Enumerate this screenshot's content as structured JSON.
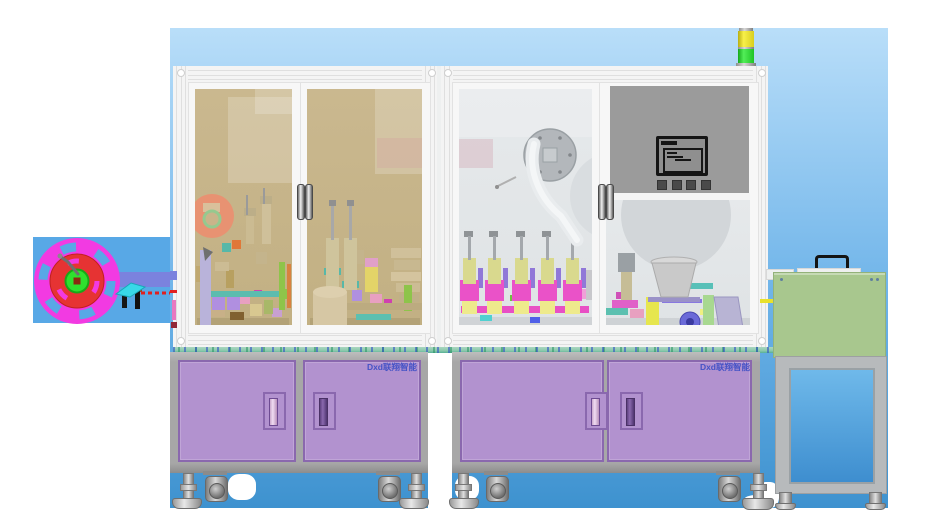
{
  "branding": {
    "label": "Dxd联翔智能",
    "label_color": "#4553c6"
  },
  "palette": {
    "sky-top": "#b9def9",
    "sky-mid": "#6fb4e9",
    "sky-bottom": "#3e92cf",
    "reel-backdrop": "#58a8e6",
    "frame": "#f2f2f2",
    "frame-line": "#dfdfdf",
    "glass-tan": "#c6b389",
    "glass-gray": "#e3e6e8",
    "panel-gray": "#9b9b9b",
    "cabinet-gray": "#a7a7a7",
    "door-purple": "#b292cf",
    "door-purple-dark": "#8a68ae",
    "label-blue": "#4553c6",
    "table-teal": "#8cc9ac",
    "table-teal-dark": "#57b096",
    "green-box": "#a8c78e",
    "unit-blue-top": "#6fb9ea",
    "unit-blue-bottom": "#3e8ecf",
    "stack-light-yellow": "#e8de25",
    "stack-light-green": "#35d53a",
    "reel-magenta": "#f23ae2",
    "reel-red": "#e63333",
    "hub-green": "#2ee12e"
  },
  "components": {
    "stack_light": "signal-tower-yellow-green",
    "film_reel": "magenta-unwind-reel",
    "hmi_monitor": "control-screen-4-buttons",
    "bowl_feeder": "vibratory-bowl-feeder",
    "rotary_disc": "gray-index-disc",
    "side_cart": "green-top-cart-blue-door"
  },
  "machinery": {
    "reel": [
      [
        95,
        272,
        75,
        15,
        "#7b82de"
      ],
      [
        122,
        290,
        5,
        18,
        "#161616"
      ],
      [
        135,
        288,
        5,
        21,
        "#111111"
      ],
      [
        133,
        285,
        9,
        7,
        "#a04818"
      ],
      [
        170,
        271,
        7,
        9,
        "#7b82de"
      ],
      [
        170,
        290,
        7,
        3,
        "#e02020"
      ],
      [
        172,
        300,
        4,
        20,
        "#e878c0"
      ],
      [
        171,
        322,
        6,
        6,
        "#902838"
      ]
    ],
    "window_l1": [
      [
        200,
        250,
        11,
        75,
        "#b9b3da"
      ],
      [
        246,
        195,
        2,
        20,
        "#9a9a9a"
      ],
      [
        263,
        188,
        2,
        16,
        "#9a9a9a"
      ],
      [
        244,
        208,
        12,
        8,
        "#bcae88"
      ],
      [
        246,
        216,
        8,
        28,
        "#cbbb92"
      ],
      [
        260,
        196,
        12,
        8,
        "#bcae88"
      ],
      [
        262,
        204,
        9,
        40,
        "#cfc09a"
      ],
      [
        279,
        262,
        6,
        48,
        "#8ec44a"
      ],
      [
        287,
        264,
        4,
        44,
        "#d8823f"
      ],
      [
        204,
        291,
        78,
        6,
        "#5cbcae"
      ],
      [
        268,
        291,
        14,
        6,
        "#e04838"
      ],
      [
        281,
        289,
        7,
        10,
        "#8ec44a"
      ],
      [
        212,
        294,
        13,
        16,
        "#b08fe0"
      ],
      [
        216,
        294,
        5,
        8,
        "#c2b083"
      ],
      [
        227,
        294,
        13,
        16,
        "#b08fe0"
      ],
      [
        231,
        294,
        5,
        8,
        "#c2b083"
      ],
      [
        196,
        266,
        10,
        16,
        "#c0a870"
      ],
      [
        215,
        262,
        14,
        9,
        "#ccbc94"
      ],
      [
        226,
        270,
        8,
        18,
        "#b8a060"
      ],
      [
        256,
        252,
        11,
        12,
        "#c4b48c"
      ],
      [
        240,
        297,
        10,
        7,
        "#e8a0c0"
      ],
      [
        254,
        290,
        8,
        6,
        "#d040b0"
      ],
      [
        250,
        304,
        12,
        12,
        "#d8c890"
      ],
      [
        230,
        312,
        14,
        8,
        "#806030"
      ],
      [
        205,
        308,
        20,
        9,
        "#c8b088"
      ],
      [
        264,
        300,
        9,
        14,
        "#a8b868"
      ],
      [
        272,
        308,
        10,
        9,
        "#c8a0d0"
      ],
      [
        197,
        318,
        92,
        8,
        "#b3a277"
      ],
      [
        222,
        243,
        9,
        9,
        "#57b8a8"
      ],
      [
        232,
        240,
        9,
        9,
        "#e07838"
      ]
    ],
    "window_l2": [
      [
        329,
        200,
        7,
        6,
        "#909090"
      ],
      [
        347,
        200,
        7,
        6,
        "#909090"
      ],
      [
        331,
        206,
        3,
        34,
        "#a8a8a8"
      ],
      [
        349,
        206,
        3,
        34,
        "#a8a8a8"
      ],
      [
        326,
        238,
        13,
        52,
        "#cfc49c"
      ],
      [
        344,
        238,
        13,
        52,
        "#cfc49c"
      ],
      [
        324,
        268,
        17,
        7,
        "#57b8a8"
      ],
      [
        342,
        281,
        17,
        7,
        "#57b8a8"
      ],
      [
        313,
        292,
        34,
        33,
        "#d6c7a4"
      ],
      [
        365,
        258,
        13,
        9,
        "#e0a0c8"
      ],
      [
        365,
        266,
        13,
        26,
        "#e3d468"
      ],
      [
        345,
        303,
        77,
        7,
        "#bcab80"
      ],
      [
        356,
        314,
        35,
        6,
        "#5cc0b0"
      ],
      [
        404,
        285,
        8,
        26,
        "#8ec44a"
      ],
      [
        391,
        248,
        30,
        10,
        "#d0c09a"
      ],
      [
        394,
        260,
        26,
        10,
        "#c8b890"
      ],
      [
        391,
        272,
        30,
        9,
        "#d4c49e"
      ],
      [
        396,
        283,
        24,
        9,
        "#ccbc94"
      ],
      [
        399,
        294,
        20,
        8,
        "#c0b088"
      ],
      [
        352,
        290,
        10,
        11,
        "#b090e0"
      ],
      [
        370,
        294,
        12,
        9,
        "#e8a0c0"
      ],
      [
        384,
        299,
        8,
        8,
        "#d040b0"
      ],
      [
        356,
        250,
        8,
        14,
        "#c4b48c"
      ],
      [
        310,
        318,
        110,
        7,
        "#b3a277"
      ]
    ],
    "window_r1": [
      [
        468,
        236,
        3,
        24,
        "#a4a8ac"
      ],
      [
        464,
        231,
        9,
        6,
        "#8f9396"
      ],
      [
        463,
        258,
        13,
        26,
        "#d9d98e"
      ],
      [
        460,
        280,
        19,
        21,
        "#ea52c8"
      ],
      [
        466,
        283,
        8,
        11,
        "#f6ddf0"
      ],
      [
        462,
        299,
        15,
        15,
        "#eeea8c"
      ],
      [
        478,
        268,
        5,
        20,
        "#9078d8"
      ],
      [
        493,
        236,
        3,
        24,
        "#a4a8ac"
      ],
      [
        489,
        231,
        9,
        6,
        "#8f9396"
      ],
      [
        488,
        258,
        13,
        26,
        "#d9d98e"
      ],
      [
        485,
        280,
        19,
        21,
        "#ea52c8"
      ],
      [
        491,
        283,
        8,
        11,
        "#f6ddf0"
      ],
      [
        487,
        299,
        15,
        15,
        "#eeea8c"
      ],
      [
        503,
        268,
        5,
        20,
        "#9078d8"
      ],
      [
        520,
        236,
        3,
        24,
        "#a4a8ac"
      ],
      [
        516,
        231,
        9,
        6,
        "#8f9396"
      ],
      [
        515,
        258,
        13,
        26,
        "#d9d98e"
      ],
      [
        512,
        280,
        19,
        21,
        "#ea52c8"
      ],
      [
        518,
        283,
        8,
        11,
        "#f6ddf0"
      ],
      [
        514,
        299,
        15,
        15,
        "#eeea8c"
      ],
      [
        530,
        268,
        5,
        20,
        "#9078d8"
      ],
      [
        546,
        236,
        3,
        24,
        "#a4a8ac"
      ],
      [
        542,
        231,
        9,
        6,
        "#8f9396"
      ],
      [
        541,
        258,
        13,
        26,
        "#d9d98e"
      ],
      [
        538,
        280,
        19,
        21,
        "#ea52c8"
      ],
      [
        544,
        283,
        8,
        11,
        "#f6ddf0"
      ],
      [
        540,
        299,
        15,
        15,
        "#eeea8c"
      ],
      [
        556,
        268,
        5,
        20,
        "#9078d8"
      ],
      [
        571,
        236,
        3,
        24,
        "#a4a8ac"
      ],
      [
        567,
        231,
        9,
        6,
        "#8f9396"
      ],
      [
        566,
        258,
        13,
        26,
        "#d9d98e"
      ],
      [
        563,
        280,
        19,
        21,
        "#ea52c8"
      ],
      [
        569,
        283,
        8,
        11,
        "#f6ddf0"
      ],
      [
        565,
        299,
        15,
        15,
        "#eeea8c"
      ],
      [
        581,
        268,
        5,
        20,
        "#9078d8"
      ],
      [
        461,
        306,
        128,
        7,
        "#e84fc4"
      ],
      [
        480,
        315,
        12,
        6,
        "#50d0d0"
      ],
      [
        530,
        317,
        10,
        6,
        "#5060e8"
      ],
      [
        510,
        295,
        8,
        6,
        "#70c040"
      ],
      [
        464,
        294,
        10,
        8,
        "#f8b0e0"
      ],
      [
        574,
        289,
        12,
        10,
        "#f0a0d8"
      ],
      [
        586,
        270,
        6,
        30,
        "#c8c8cc"
      ],
      [
        459,
        317,
        133,
        8,
        "#d0d3d6"
      ]
    ],
    "window_r2": [
      [
        670,
        236,
        3,
        20,
        "#a4a8ac"
      ],
      [
        648,
        297,
        52,
        5,
        "#9a92c8"
      ],
      [
        618,
        253,
        17,
        19,
        "#9aa0a4"
      ],
      [
        621,
        272,
        11,
        28,
        "#c6bd96"
      ],
      [
        612,
        300,
        26,
        8,
        "#e060c8"
      ],
      [
        616,
        292,
        12,
        7,
        "#d050b8"
      ],
      [
        604,
        308,
        24,
        7,
        "#5cc0b0"
      ],
      [
        646,
        297,
        13,
        31,
        "#e6e64e"
      ],
      [
        703,
        295,
        11,
        33,
        "#a8d890"
      ],
      [
        687,
        283,
        26,
        6,
        "#58c0b8"
      ],
      [
        662,
        299,
        40,
        4,
        "#8878e0"
      ],
      [
        630,
        309,
        14,
        9,
        "#e8a0c0"
      ],
      [
        700,
        309,
        10,
        6,
        "#f0f080"
      ],
      [
        606,
        318,
        144,
        7,
        "#ced2d5"
      ]
    ]
  }
}
